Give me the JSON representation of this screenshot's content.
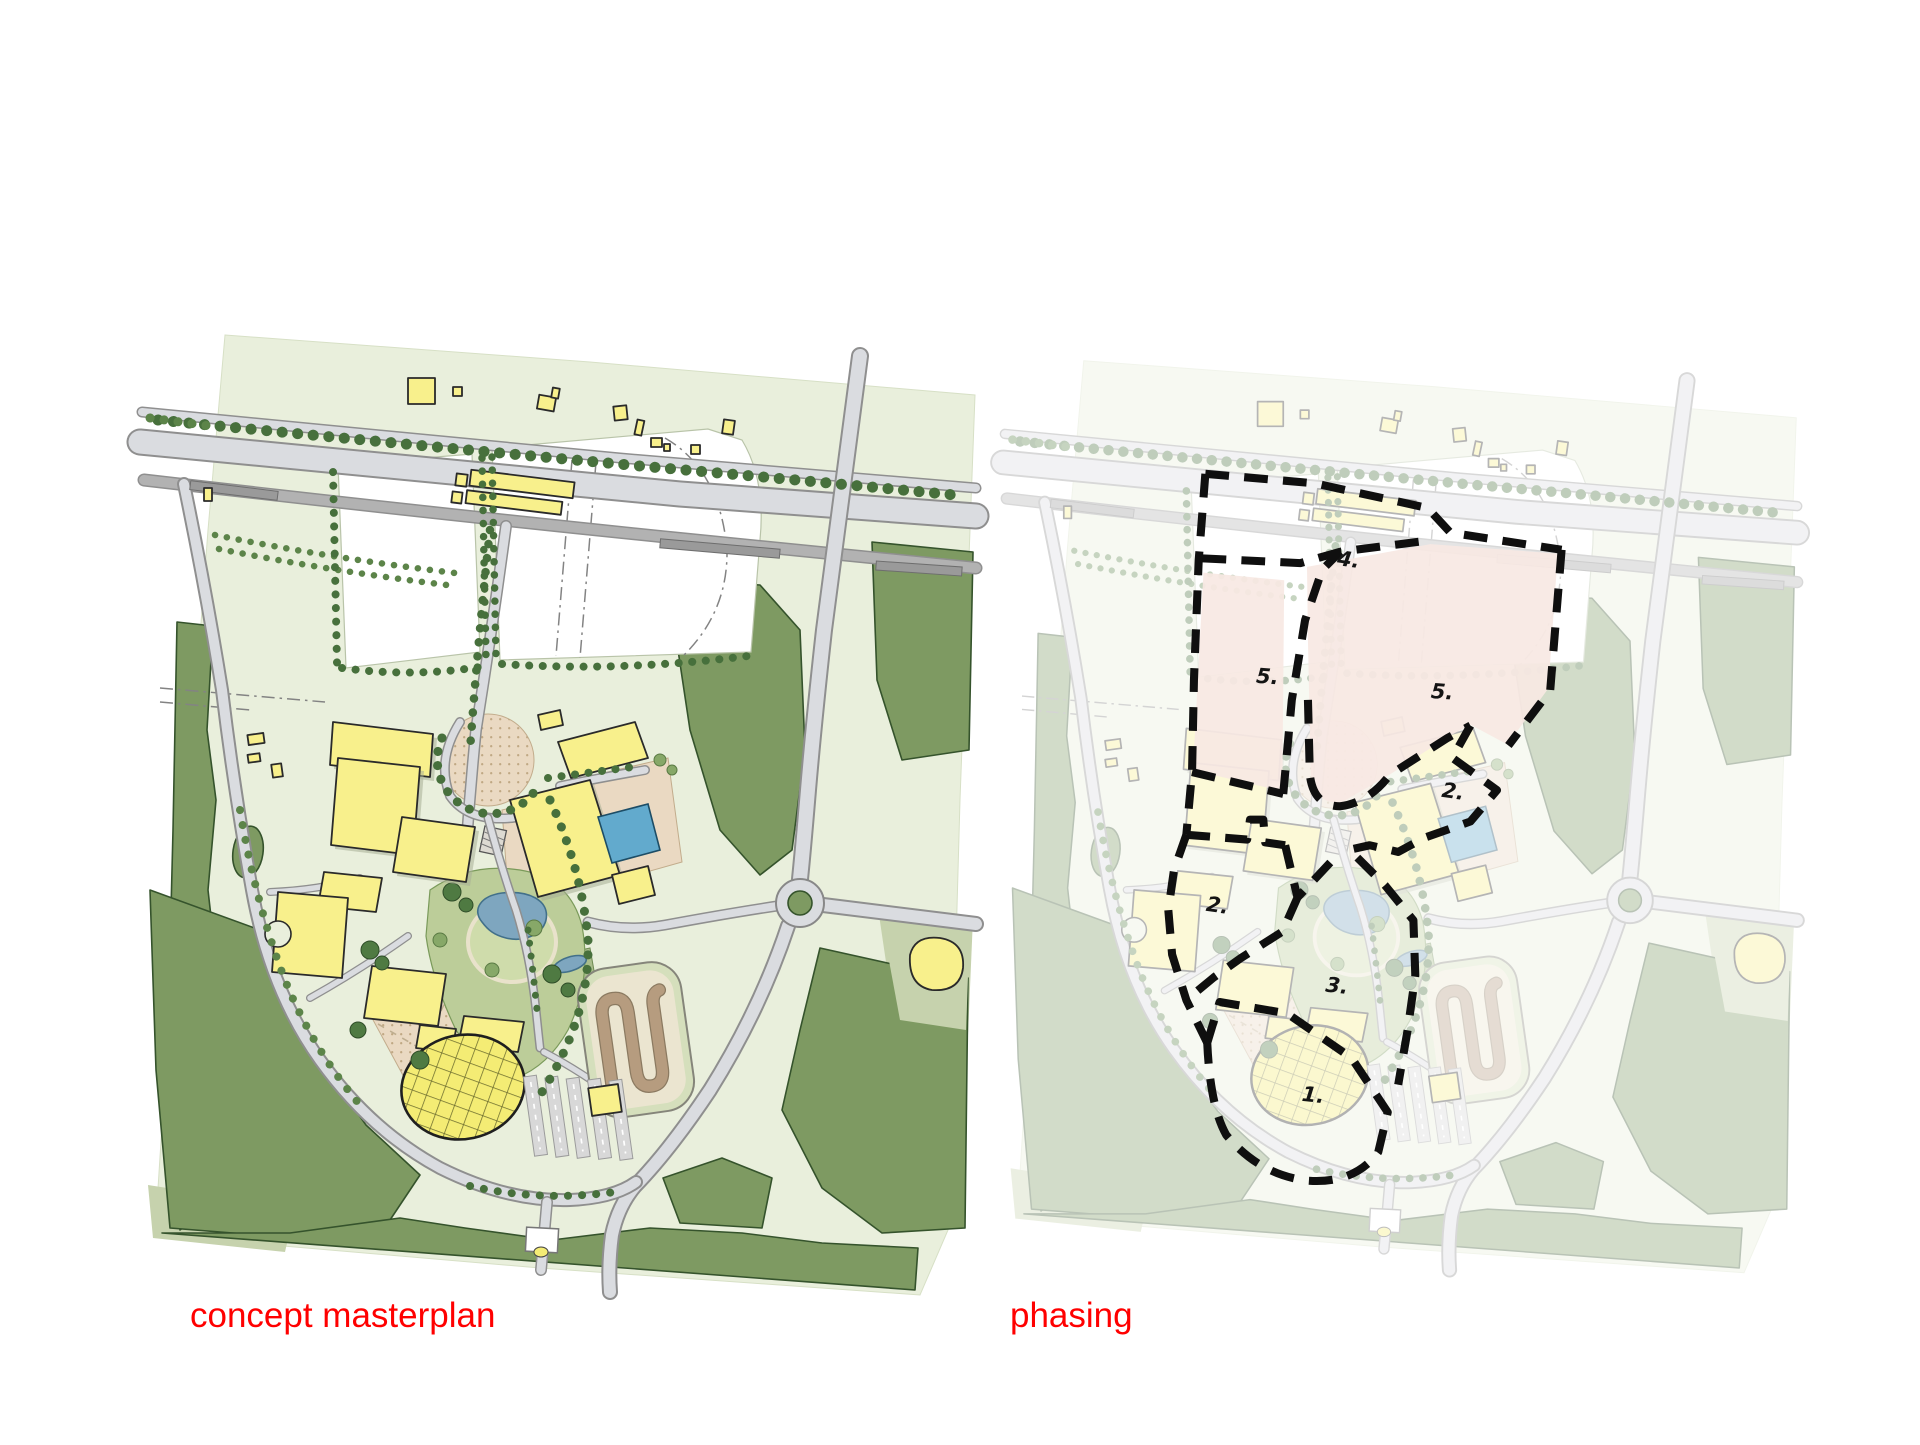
{
  "figure": {
    "background": "#ffffff",
    "type": "architectural site plan comparison, two panels"
  },
  "captions": {
    "left": "concept masterplan",
    "right": "phasing",
    "color": "#ff0000"
  },
  "phasing": {
    "boundary_style": "thick black dashed outline",
    "labels": [
      {
        "text": "1."
      },
      {
        "text": "2."
      },
      {
        "text": "2."
      },
      {
        "text": "3."
      },
      {
        "text": "4."
      },
      {
        "text": "5."
      },
      {
        "text": "5."
      }
    ]
  },
  "palette": {
    "background_field": "#e9efdc",
    "woodland_dark_green": "#7e9a62",
    "park_green": "#bccd99",
    "building_yellow": "#f8f08c",
    "road_grey": "#dadce0",
    "rail_grey": "#b2b2b2",
    "plaza_tan": "#ead9c2",
    "water_blue": "#7ea6bf",
    "pool_blue": "#62aacd",
    "phase_plot_pink": "#f7e8e3",
    "phase_boundary_black": "#0f0f0f",
    "caption_red": "#ff0000"
  }
}
